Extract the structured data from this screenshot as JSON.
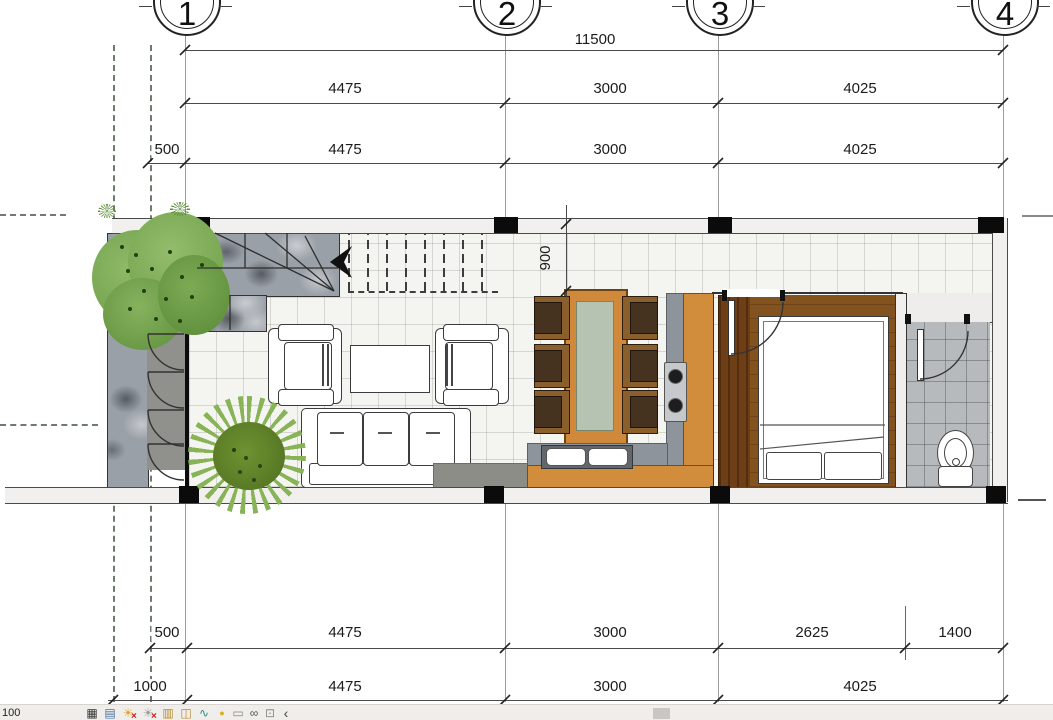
{
  "grid": {
    "bubbles": [
      "1",
      "2",
      "3",
      "4"
    ]
  },
  "dimensions": {
    "overall": "11500",
    "top_row2": [
      "4475",
      "3000",
      "4025"
    ],
    "top_row3": [
      "500",
      "4475",
      "3000",
      "4025"
    ],
    "bottom_row1": [
      "500",
      "4475",
      "3000",
      "2625",
      "1400"
    ],
    "bottom_row2": [
      "1000",
      "4475",
      "3000",
      "4025"
    ],
    "stair_width": "900"
  },
  "toolbar": {
    "scale": "100",
    "x_mark": "×",
    "icons": [
      {
        "name": "detail-level-icon",
        "glyph": "▦",
        "color": "#333333"
      },
      {
        "name": "visual-style-icon",
        "glyph": "▤",
        "color": "#4a6fa5"
      },
      {
        "name": "sun-path-icon",
        "glyph": "☀",
        "color": "#e0a420"
      },
      {
        "name": "shadows-icon",
        "glyph": "☀",
        "color": "#9a9a9a"
      },
      {
        "name": "crop-view-icon",
        "glyph": "▥",
        "color": "#b5892c"
      },
      {
        "name": "show-crop-region-icon",
        "glyph": "◫",
        "color": "#b5892c"
      },
      {
        "name": "reveal-constraints-icon",
        "glyph": "∿",
        "color": "#2e8b8b"
      },
      {
        "name": "reveal-hidden-elements-icon",
        "glyph": "●",
        "color": "#d4b11c"
      },
      {
        "name": "temporary-view-icon",
        "glyph": "▭",
        "color": "#8a8a8a"
      },
      {
        "name": "temporary-hide-isolate-icon",
        "glyph": "∞",
        "color": "#555555"
      },
      {
        "name": "dimension-lock-icon",
        "glyph": "⊡",
        "color": "#8a8a8a"
      },
      {
        "name": "collapse-chevron-icon",
        "glyph": "‹",
        "color": "#444444"
      }
    ]
  },
  "colors": {
    "counter_orange": "#d28d3c",
    "counter_gray": "#8e949b",
    "wood_dark": "#6e3f17",
    "wood_floor": "#83531f",
    "table_top": "#b6c3b3",
    "door_red": "#ae3c24",
    "foliage": "#7cab54",
    "bath_tile": "#b7babc"
  }
}
